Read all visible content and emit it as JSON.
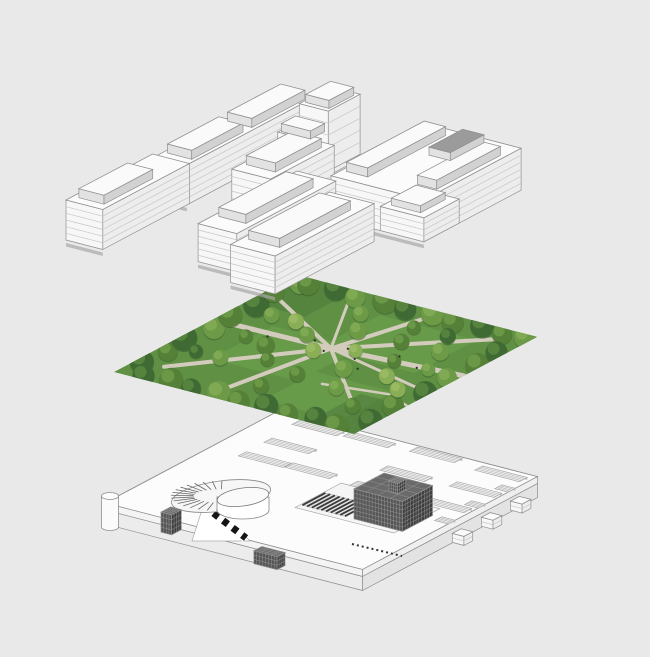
{
  "scene": {
    "width": 650,
    "height": 657,
    "description": "Exploded axonometric architectural diagram: building massing layer above, park aerial photo layer in middle, podium level with skylights and ramp below",
    "background": "#e9e9e9"
  },
  "axes": {
    "e1": [
      0.968,
      0.25
    ],
    "e2": [
      0.884,
      -0.469
    ]
  },
  "colors": {
    "buildings": {
      "top": "#fbfbfb",
      "sw": "#f7f7f7",
      "se": "#ededed",
      "floor": "#c6c6c6",
      "line": "#8f8f8f",
      "shadow": "#a6a6a6",
      "dark1": "#565656",
      "dark2": "#3f3f3f",
      "darkTopFill": "#6a6a6a",
      "grid": "#9a9a9a",
      "panelTop": "#fafafa",
      "panelSW": "#e2e2e2",
      "panelSE": "#d2d2d2",
      "darkTop": "#9b9b9b",
      "darkPanelSW": "#8e8e8e",
      "darkPanelSE": "#7f7f7f"
    },
    "park": {
      "lawn": "#5f9044",
      "lawnLight": "#6da24e",
      "lawnDark": "#4c7a3b",
      "path": "#d3ccbd",
      "people": "#2f2f2f",
      "treeTones": [
        "#3f6a33",
        "#558038",
        "#6c9a46",
        "#89ae56"
      ],
      "treeHighlight": [
        "#5c8a41",
        "#6f9d4a",
        "#84ad55",
        "#9dbd66"
      ]
    },
    "podium": {
      "top": "#fcfcfc",
      "band1sw": "#f4f4f4",
      "band2sw": "#ececec",
      "band1se": "#efefef",
      "band2se": "#e3e3e3",
      "line": "#8e8e8e",
      "slotFill": "#f2f2f2",
      "slotShade": "#c2c2c2",
      "slotLine": "#a8a8a8",
      "openFill": "#f5f5f5",
      "stair": "#3a3a3a",
      "dash": "#151515"
    }
  },
  "layers": {
    "buildings": {
      "name": "buildings-massing-layer",
      "origin": [
        66,
        240
      ],
      "boxes": [
        {
          "id": "west-bar-b",
          "u": 5,
          "v": 95,
          "a": 33,
          "b": 145,
          "h": 40,
          "floors": 6,
          "shadow": true
        },
        {
          "id": "mid-tower-lower",
          "u": 58,
          "v": 176,
          "a": 40,
          "b": 46,
          "h": 40,
          "floors": 5
        },
        {
          "id": "mid-tower-upper",
          "u": 62,
          "v": 196,
          "a": 30,
          "b": 36,
          "h": 60,
          "floors": 5
        },
        {
          "id": "dark-tower",
          "u": 138,
          "v": 178,
          "a": 28,
          "b": 28,
          "h": 34,
          "style": "dark"
        },
        {
          "id": "mid-slab",
          "u": 80,
          "v": 100,
          "a": 40,
          "b": 72,
          "h": 44,
          "floors": 6,
          "shadow": true
        },
        {
          "id": "east-block",
          "u": 155,
          "v": 130,
          "a": 96,
          "b": 110,
          "h": 42,
          "floors": 6,
          "shadow": true
        },
        {
          "id": "east-block-low",
          "u": 206,
          "v": 130,
          "a": 45,
          "b": 40,
          "h": 24,
          "floors": 4
        },
        {
          "id": "west-bar-a",
          "u": 0,
          "v": 0,
          "a": 38,
          "b": 98,
          "h": 40,
          "floors": 6,
          "shadow": true
        },
        {
          "id": "front-left-slab",
          "u": 120,
          "v": 18,
          "a": 40,
          "b": 112,
          "h": 38,
          "floors": 6,
          "shadow": true
        },
        {
          "id": "front-right-slab",
          "u": 170,
          "v": 0,
          "a": 46,
          "b": 112,
          "h": 38,
          "floors": 6,
          "shadow": true
        }
      ],
      "panels": [
        {
          "u": 6,
          "v": 8,
          "a": 26,
          "b": 55,
          "z": 40,
          "h": 9
        },
        {
          "u": 9,
          "v": 105,
          "a": 25,
          "b": 58,
          "z": 40,
          "h": 9
        },
        {
          "u": 9,
          "v": 173,
          "a": 25,
          "b": 60,
          "z": 40,
          "h": 9
        },
        {
          "u": 84,
          "v": 112,
          "a": 30,
          "b": 52,
          "z": 44,
          "h": 9
        },
        {
          "u": 60,
          "v": 178,
          "a": 30,
          "b": 16,
          "z": 40,
          "h": 8
        },
        {
          "u": 65,
          "v": 200,
          "a": 24,
          "b": 28,
          "z": 60,
          "h": 8
        },
        {
          "u": 160,
          "v": 142,
          "a": 22,
          "b": 88,
          "z": 42,
          "h": 9
        },
        {
          "u": 226,
          "v": 150,
          "a": 20,
          "b": 72,
          "z": 42,
          "h": 9
        },
        {
          "u": 196,
          "v": 196,
          "a": 22,
          "b": 38,
          "z": 42,
          "h": 8,
          "darkTop": true
        },
        {
          "u": 212,
          "v": 136,
          "a": 30,
          "b": 28,
          "z": 24,
          "h": 7
        },
        {
          "u": 125,
          "v": 36,
          "a": 28,
          "b": 76,
          "z": 38,
          "h": 9
        },
        {
          "u": 176,
          "v": 14,
          "a": 32,
          "b": 80,
          "z": 38,
          "h": 9
        }
      ]
    },
    "park": {
      "name": "park-aerial-photo-layer",
      "origin": [
        114,
        372
      ],
      "a": 248,
      "b": 207,
      "lawns": [
        {
          "u": 50,
          "v": 55,
          "a": 90,
          "b": 70,
          "tone": "light"
        },
        {
          "u": 110,
          "v": 110,
          "a": 100,
          "b": 70,
          "tone": "light"
        },
        {
          "u": 140,
          "v": 15,
          "a": 80,
          "b": 60,
          "tone": "light"
        },
        {
          "u": 0,
          "v": 150,
          "a": 60,
          "b": 57,
          "tone": "dark"
        },
        {
          "u": 200,
          "v": 0,
          "a": 48,
          "b": 60,
          "tone": "dark"
        }
      ],
      "paths": [
        {
          "pts": [
            [
              0,
              112
            ],
            [
              120,
              114
            ],
            [
              248,
              124
            ]
          ],
          "w": 5
        },
        {
          "pts": [
            [
              28,
              26
            ],
            [
              120,
              114
            ],
            [
              230,
              194
            ]
          ],
          "w": 4
        },
        {
          "pts": [
            [
              18,
              166
            ],
            [
              120,
              114
            ],
            [
              216,
              36
            ]
          ],
          "w": 4
        },
        {
          "pts": [
            [
              96,
              4
            ],
            [
              120,
              114
            ],
            [
              150,
              205
            ]
          ],
          "w": 4
        },
        {
          "pts": [
            [
              120,
              114
            ],
            [
              248,
              86
            ]
          ],
          "w": 3
        },
        {
          "pts": [
            [
              60,
              204
            ],
            [
              96,
              150
            ],
            [
              120,
              114
            ]
          ],
          "w": 3
        },
        {
          "pts": [
            [
              160,
              60
            ],
            [
              220,
              70
            ],
            [
              248,
              60
            ]
          ],
          "w": 2.5
        }
      ],
      "trees": [
        [
          6,
          25,
          12,
          0
        ],
        [
          10,
          50,
          10,
          1
        ],
        [
          4,
          75,
          13,
          0
        ],
        [
          12,
          100,
          11,
          2
        ],
        [
          6,
          125,
          12,
          1
        ],
        [
          10,
          150,
          13,
          0
        ],
        [
          5,
          175,
          11,
          1
        ],
        [
          14,
          195,
          10,
          2
        ],
        [
          20,
          198,
          11,
          1
        ],
        [
          45,
          202,
          12,
          0
        ],
        [
          70,
          196,
          10,
          2
        ],
        [
          95,
          203,
          13,
          1
        ],
        [
          120,
          198,
          11,
          0
        ],
        [
          145,
          202,
          12,
          2
        ],
        [
          170,
          197,
          11,
          1
        ],
        [
          195,
          203,
          12,
          0
        ],
        [
          220,
          198,
          10,
          1
        ],
        [
          240,
          202,
          11,
          2
        ],
        [
          25,
          6,
          11,
          0
        ],
        [
          50,
          10,
          12,
          1
        ],
        [
          75,
          5,
          10,
          0
        ],
        [
          100,
          9,
          12,
          2
        ],
        [
          125,
          4,
          11,
          1
        ],
        [
          150,
          8,
          12,
          0
        ],
        [
          175,
          5,
          10,
          1
        ],
        [
          200,
          9,
          11,
          0
        ],
        [
          225,
          5,
          12,
          1
        ],
        [
          242,
          25,
          12,
          0
        ],
        [
          238,
          55,
          11,
          1
        ],
        [
          244,
          85,
          12,
          0
        ],
        [
          239,
          115,
          10,
          2
        ],
        [
          243,
          145,
          12,
          1
        ],
        [
          240,
          170,
          11,
          0
        ],
        [
          55,
          60,
          8,
          2
        ],
        [
          70,
          95,
          9,
          1
        ],
        [
          60,
          140,
          8,
          3
        ],
        [
          85,
          125,
          8,
          2
        ],
        [
          90,
          75,
          7,
          1
        ],
        [
          110,
          105,
          8,
          3
        ],
        [
          115,
          150,
          9,
          2
        ],
        [
          130,
          65,
          8,
          1
        ],
        [
          140,
          120,
          7,
          3
        ],
        [
          155,
          90,
          9,
          2
        ],
        [
          160,
          150,
          8,
          1
        ],
        [
          175,
          60,
          8,
          2
        ],
        [
          180,
          120,
          7,
          1
        ],
        [
          195,
          95,
          8,
          3
        ],
        [
          200,
          150,
          9,
          2
        ],
        [
          210,
          40,
          8,
          1
        ],
        [
          215,
          120,
          7,
          2
        ],
        [
          120,
          35,
          8,
          1
        ],
        [
          95,
          175,
          8,
          2
        ],
        [
          150,
          175,
          7,
          1
        ],
        [
          185,
          175,
          8,
          0
        ],
        [
          220,
          80,
          8,
          3
        ],
        [
          45,
          100,
          7,
          1
        ],
        [
          35,
          140,
          8,
          2
        ],
        [
          30,
          60,
          7,
          0
        ]
      ],
      "people": [
        [
          118,
          108
        ],
        [
          132,
          120
        ],
        [
          150,
          108
        ],
        [
          98,
          120
        ],
        [
          165,
          95
        ],
        [
          178,
          128
        ],
        [
          60,
          108
        ],
        [
          205,
          118
        ]
      ]
    },
    "podium": {
      "name": "podium-level-layer",
      "origin": [
        105,
        503
      ],
      "a": 266,
      "b": 198,
      "slabTopH": 7,
      "slabBotH": 14,
      "slots": [
        {
          "u": 27,
          "v": 182
        },
        {
          "u": 78,
          "v": 184
        },
        {
          "u": 31,
          "v": 146
        },
        {
          "u": 144,
          "v": 187
        },
        {
          "u": 31,
          "v": 117
        },
        {
          "u": 78,
          "v": 118
        },
        {
          "u": 148,
          "v": 149
        },
        {
          "u": 214,
          "v": 184
        },
        {
          "u": 147,
          "v": 116
        },
        {
          "u": 217,
          "v": 152
        },
        {
          "u": 216,
          "v": 119
        }
      ],
      "slotSize": {
        "a": 46,
        "b": 9
      },
      "notches": [
        {
          "u": 252,
          "v": 165,
          "a": 14,
          "b": 8
        },
        {
          "u": 252,
          "v": 131,
          "a": 14,
          "b": 8
        },
        {
          "u": 252,
          "v": 97,
          "a": 14,
          "b": 8
        }
      ],
      "outerBoxes": [
        {
          "u": 270,
          "v": 163,
          "a": 12,
          "b": 10,
          "z": -16,
          "h": 9,
          "floors": 2
        },
        {
          "u": 271,
          "v": 129,
          "a": 12,
          "b": 10,
          "z": -16,
          "h": 9,
          "floors": 2
        },
        {
          "u": 272,
          "v": 95,
          "a": 12,
          "b": 10,
          "z": -16,
          "h": 9,
          "floors": 2
        }
      ],
      "opening": {
        "u": 138,
        "v": 64,
        "a": 102,
        "b": 52
      },
      "stairs": {
        "u": 140,
        "v": 70,
        "a": 44,
        "b": 26,
        "steps": 9
      },
      "pavilion": {
        "u": 186,
        "v": 78,
        "a": 50,
        "b": 34,
        "z": -6,
        "h": 30,
        "style": "dark"
      },
      "vent": {
        "u": 182,
        "v": 122,
        "a": 9,
        "b": 9,
        "h": 10,
        "style": "dark"
      },
      "rampTower": {
        "u": 56,
        "v": 2,
        "a": 11,
        "b": 11,
        "z": -16,
        "h": 20,
        "style": "dark"
      },
      "frontHatchBox": {
        "u": 162,
        "v": -9,
        "a": 24,
        "b": 9,
        "z": -16,
        "h": 13,
        "style": "dark"
      },
      "ramp": {
        "outer": {
          "cx": 221,
          "cy": 496,
          "rx": 50,
          "ry": 15,
          "rot": -8
        },
        "inner": {
          "cx": 243,
          "cy": 497,
          "rx": 26,
          "ry": 9,
          "rot": -8
        },
        "wedge": [
          [
            206,
            497
          ],
          [
            250,
            541
          ],
          [
            192,
            541
          ]
        ],
        "stripe": {
          "x1": 204,
          "y1": 506,
          "x2": 246,
          "y2": 538,
          "w": 7,
          "dash": "6 6"
        }
      },
      "westCylinder": {
        "cx": 110,
        "cy": 496,
        "rx": 8.5,
        "ry": 3.5,
        "h": 31
      },
      "dashTicks": {
        "x1": 352,
        "y1": 544,
        "x2": 402,
        "y2": 556
      }
    }
  }
}
